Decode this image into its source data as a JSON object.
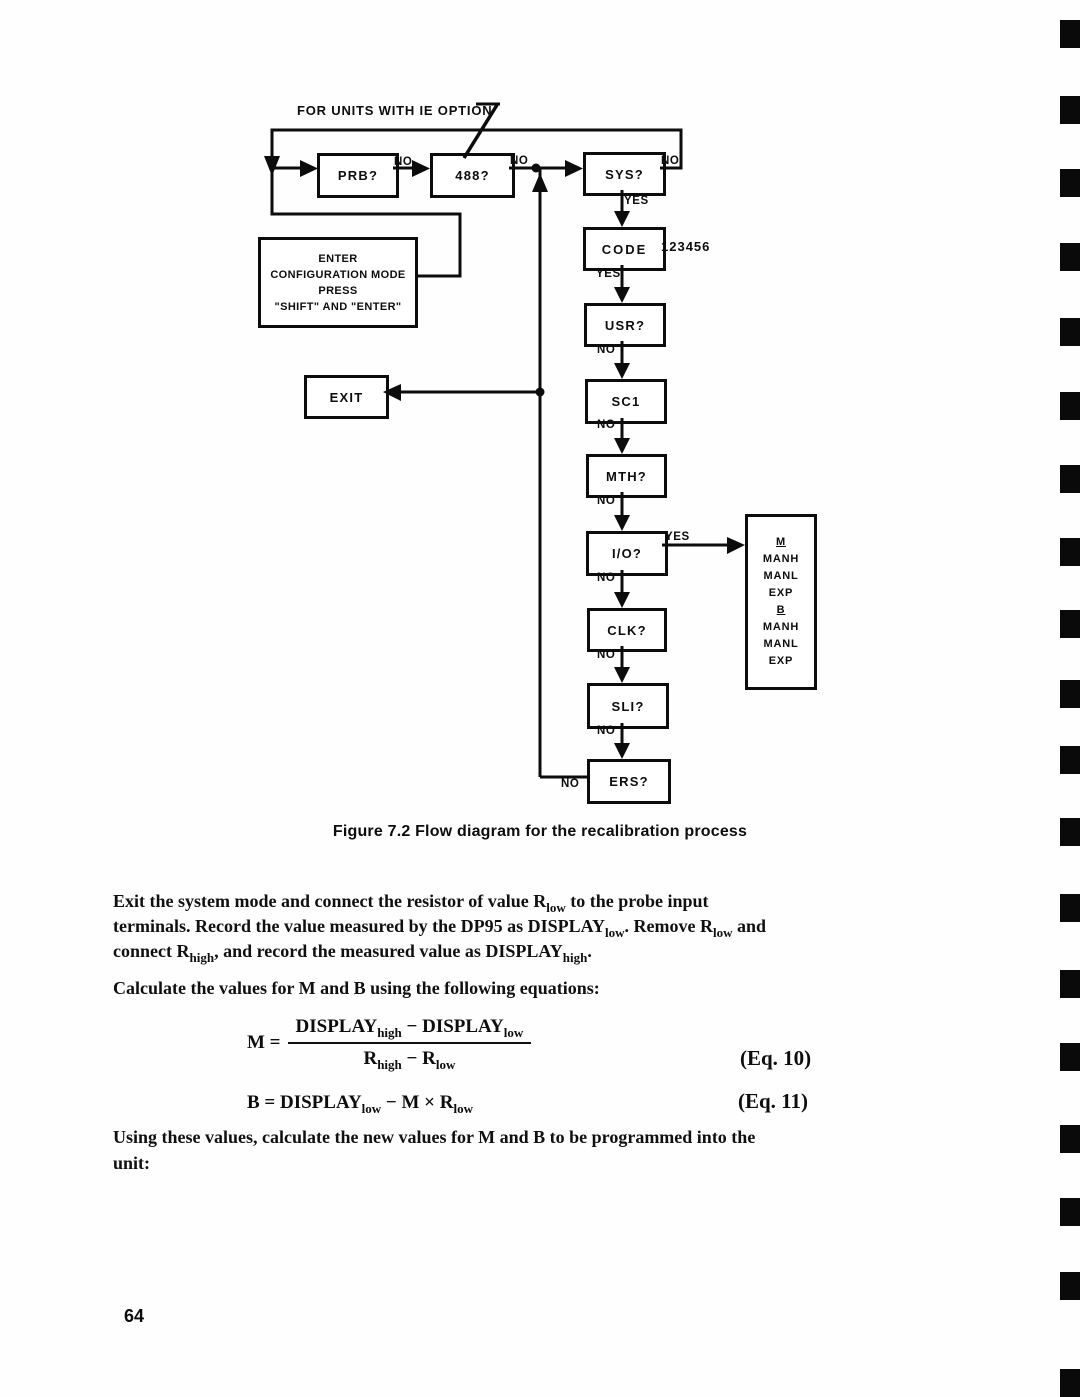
{
  "figure": {
    "annotation": "FOR UNITS WITH IE OPTION",
    "caption": "Figure 7.2 Flow diagram for the recalibration process",
    "nodes": {
      "prb": "PRB?",
      "box488": "488?",
      "sys": "SYS?",
      "code": "CODE",
      "code_value": "123456",
      "usr": "USR?",
      "sc1": "SC1",
      "mth": "MTH?",
      "io": "I/O?",
      "clk": "CLK?",
      "sli": "SLI?",
      "ers": "ERS?",
      "exit": "EXIT"
    },
    "config_box": {
      "l1": "ENTER",
      "l2": "CONFIGURATION MODE",
      "l3": "PRESS",
      "l4": "\"SHIFT\" AND \"ENTER\""
    },
    "manual_box": {
      "l1": "M",
      "l2": "MANH",
      "l3": "MANL",
      "l4": "EXP",
      "l5": "B",
      "l6": "MANH",
      "l7": "MANL",
      "l8": "EXP"
    },
    "labels": {
      "yes": "YES",
      "no": "NO"
    }
  },
  "body": {
    "p1": {
      "l1s1": "Exit the system mode and connect the resistor of value R",
      "l1sub1": "low",
      "l1s2": " to the probe input",
      "l2s1": "terminals. Record the value measured by the DP95 as DISPLAY",
      "l2sub1": "low",
      "l2s2": ". Remove R",
      "l2sub2": "low",
      "l2s3": " and",
      "l3s1": "connect R",
      "l3sub1": "high",
      "l3s2": ", and record the measured value as DISPLAY",
      "l3sub2": "high",
      "l3s3": "."
    },
    "p2": "Calculate the values for M and B using the following equations:",
    "eq10": {
      "lhs": "M =",
      "num_t1": "DISPLAY",
      "num_sub1": "high",
      "num_t2": " − DISPLAY",
      "num_sub2": "low",
      "den_t1": "R",
      "den_sub1": "high",
      "den_t2": " − R",
      "den_sub2": "low",
      "tag": "(Eq. 10)"
    },
    "eq11": {
      "t1": "B = DISPLAY",
      "sub1": "low",
      "t2": " − M × R",
      "sub2": "low",
      "tag": "(Eq. 11)"
    },
    "p3_line1": "Using these values, calculate the new values for M and B to be programmed into the",
    "p3_line2": "unit:",
    "page_number": "64"
  }
}
